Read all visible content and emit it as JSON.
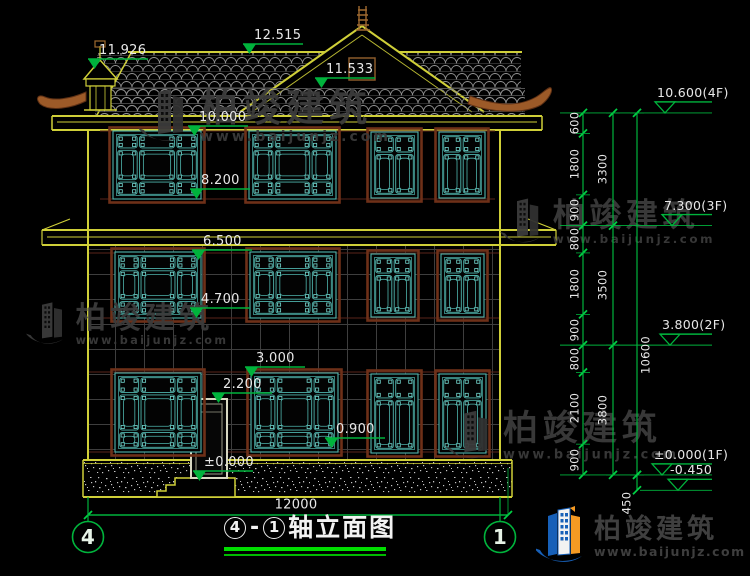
{
  "title_block": {
    "axis_left": "4",
    "separator": "-",
    "axis_right": "1",
    "name": "轴立面图"
  },
  "horizontal_dimension": {
    "label": "12000"
  },
  "axis_bubbles": [
    {
      "label": "4",
      "x": 88,
      "y": 537
    },
    {
      "label": "1",
      "x": 500,
      "y": 537
    }
  ],
  "left_elevation_markers": [
    {
      "label": "11.926",
      "x": 88,
      "y": 59
    },
    {
      "label": "12.515",
      "x": 243,
      "y": 44
    },
    {
      "label": "11.533",
      "x": 315,
      "y": 78
    },
    {
      "label": "10.000",
      "x": 188,
      "y": 126
    },
    {
      "label": "8.200",
      "x": 190,
      "y": 189
    },
    {
      "label": "6.500",
      "x": 192,
      "y": 250
    },
    {
      "label": "4.700",
      "x": 190,
      "y": 308
    },
    {
      "label": "3.000",
      "x": 245,
      "y": 367
    },
    {
      "label": "2.200",
      "x": 212,
      "y": 393
    },
    {
      "label": "0.900",
      "x": 325,
      "y": 438
    },
    {
      "label": "±0.000",
      "x": 193,
      "y": 471
    }
  ],
  "right_elevation_markers": [
    {
      "label": "10.600(4F)",
      "level_mm": 10600,
      "tri_x": 655
    },
    {
      "label": "7.300(3F)",
      "level_mm": 7300,
      "tri_x": 662
    },
    {
      "label": "3.800(2F)",
      "level_mm": 3800,
      "tri_x": 660
    },
    {
      "label": "±0.000(1F)",
      "level_mm": 0,
      "tri_x": 652
    },
    {
      "label": "-0.450",
      "level_mm": -450,
      "tri_x": 668
    }
  ],
  "vertical_dimension_chains": [
    {
      "x": 583,
      "label_x": 575,
      "segments": [
        600,
        1800,
        900,
        800,
        1800,
        900,
        800,
        2100,
        900
      ]
    },
    {
      "x": 613,
      "label_x": 603,
      "segments": [
        3300,
        3500,
        3800
      ]
    },
    {
      "x": 637,
      "label_x": 646,
      "segments": [
        10600
      ],
      "label_y_override": [
        355
      ]
    }
  ],
  "extra_dimension": {
    "label": "450",
    "x": 637,
    "label_pos": [
      627,
      503
    ],
    "from_mm": 0,
    "to_mm": -450
  },
  "scale": {
    "px_per_mm": 0.0341509,
    "zero_y": 474.9,
    "top_y": 112.9
  },
  "watermark": {
    "brand": "柏竣建筑",
    "site": "www.baijunjz.com",
    "instances": [
      {
        "x": 138,
        "y": 86,
        "scale": 1.0
      },
      {
        "x": 26,
        "y": 300,
        "scale": 0.8
      },
      {
        "x": 500,
        "y": 196,
        "scale": 0.85
      },
      {
        "x": 446,
        "y": 408,
        "scale": 0.92
      }
    ]
  },
  "logo": {
    "brand": "柏竣建筑",
    "site": "www.baijunjz.com"
  },
  "colors": {
    "line_green": "#00b33c",
    "cad_yellow": "#cfcf38",
    "teal": "#4fb5ad",
    "brown_frame": "#7a3a20",
    "ornament_brown": "#9c5a28",
    "text_white": "#e8e8e8",
    "title_underline": "#00dd00",
    "watermark_gray": "#3b3b3b",
    "logo_blue": "#1760b8",
    "logo_orange": "#f59a23"
  }
}
